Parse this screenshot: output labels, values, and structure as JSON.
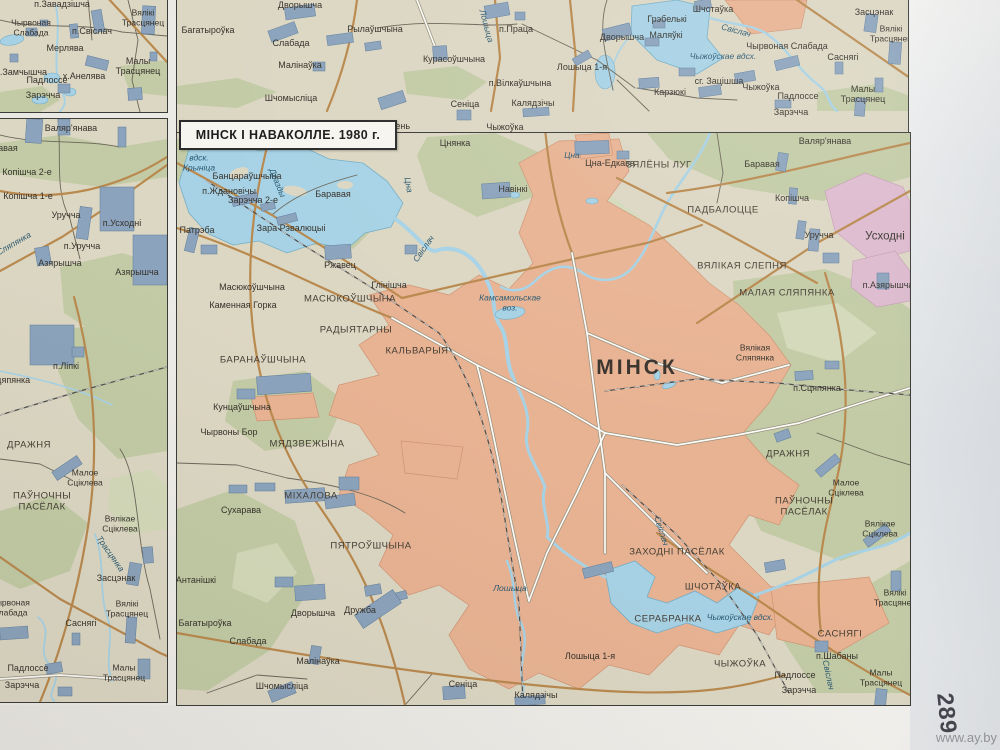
{
  "title": "МІНСК І НАВАКОЛЛЕ. 1980 г.",
  "page": {
    "number": "289",
    "watermark": "www.ay.by"
  },
  "colors": {
    "land": "#dcd7c3",
    "forest": "#c2cba5",
    "forest_light": "#d3d9b9",
    "urban": "#e8b393",
    "urban_edge": "#cf9474",
    "pink": "#ddbace",
    "water": "#a7d2e5",
    "water_edge": "#74aec7",
    "road_major": "#b9894e",
    "road_minor": "#fdfcf8",
    "road_casing": "#98927f",
    "road_small": "#6b6659",
    "rail": "#4e4c48",
    "building": "#8ba3bc",
    "building_edge": "#5f7d9c",
    "border": "#3b3b39",
    "label": "#36322b",
    "label_water": "#2c5a72",
    "title_bg": "#f7f5ef"
  },
  "panels": {
    "top_left": {
      "labels": [
        {
          "t": "п.Завадзішча",
          "x": 62,
          "y": 4,
          "c": "s"
        },
        {
          "t": "Чырвоная\nСлабада",
          "x": 31,
          "y": 28,
          "c": "s2"
        },
        {
          "t": "Вялікі\nТрасцянец",
          "x": 143,
          "y": 18,
          "c": "s2"
        },
        {
          "t": "п.Свіслач",
          "x": 92,
          "y": 31,
          "c": "s"
        },
        {
          "t": "Мерлява",
          "x": 65,
          "y": 48,
          "c": "s"
        },
        {
          "t": "Малы Трасцянец",
          "x": 138,
          "y": 66,
          "c": "s"
        },
        {
          "t": "п.Замчышча",
          "x": 21,
          "y": 72,
          "c": "s"
        },
        {
          "t": "х.Анелява",
          "x": 84,
          "y": 76,
          "c": "s"
        },
        {
          "t": "Падлоссе",
          "x": 47,
          "y": 80,
          "c": "s"
        },
        {
          "t": "Зарэчча",
          "x": 43,
          "y": 95,
          "c": "s"
        }
      ]
    },
    "top_right": {
      "labels": [
        {
          "t": "Багатыроўка",
          "x": 31,
          "y": 30,
          "c": "s"
        },
        {
          "t": "Дворышча",
          "x": 123,
          "y": 5,
          "c": "s"
        },
        {
          "t": "Рылаўшчына",
          "x": 198,
          "y": 29,
          "c": "s"
        },
        {
          "t": "Слабада",
          "x": 114,
          "y": 43,
          "c": "s"
        },
        {
          "t": "Малінаўка",
          "x": 123,
          "y": 65,
          "c": "s"
        },
        {
          "t": "Шчомысліца",
          "x": 114,
          "y": 98,
          "c": "s"
        },
        {
          "t": "Курасоўшчына",
          "x": 277,
          "y": 59,
          "c": "s"
        },
        {
          "t": "Лошыца",
          "x": 309,
          "y": 26,
          "c": "w2",
          "r": 75
        },
        {
          "t": "п.Праца",
          "x": 339,
          "y": 29,
          "c": "s"
        },
        {
          "t": "п.Вілкаўшчына",
          "x": 343,
          "y": 83,
          "c": "s"
        },
        {
          "t": "Сеніца",
          "x": 288,
          "y": 104,
          "c": "s"
        },
        {
          "t": "Калядзічы",
          "x": 356,
          "y": 103,
          "c": "s"
        },
        {
          "t": "Лошыца 1-я",
          "x": 405,
          "y": 67,
          "c": "s"
        },
        {
          "t": "Дворышча",
          "x": 445,
          "y": 37,
          "c": "s"
        },
        {
          "t": "Грэбелькі",
          "x": 490,
          "y": 19,
          "c": "s"
        },
        {
          "t": "Шчотаўка",
          "x": 536,
          "y": 9,
          "c": "s"
        },
        {
          "t": "Маляўкі",
          "x": 489,
          "y": 35,
          "c": "s"
        },
        {
          "t": "Свіслач",
          "x": 559,
          "y": 31,
          "c": "w2",
          "r": 15
        },
        {
          "t": "Чырвоная Слабада",
          "x": 610,
          "y": 46,
          "c": "s"
        },
        {
          "t": "Чыжоўскае вдсх.",
          "x": 546,
          "y": 57,
          "c": "w2"
        },
        {
          "t": "сг. Зацішша",
          "x": 542,
          "y": 81,
          "c": "s"
        },
        {
          "t": "Чыжоўка",
          "x": 584,
          "y": 87,
          "c": "s"
        },
        {
          "t": "Карзюкі",
          "x": 493,
          "y": 92,
          "c": "s"
        },
        {
          "t": "Падлоссе",
          "x": 621,
          "y": 96,
          "c": "s"
        },
        {
          "t": "Зарэчча",
          "x": 614,
          "y": 112,
          "c": "s"
        },
        {
          "t": "Саснягі",
          "x": 666,
          "y": 57,
          "c": "s"
        },
        {
          "t": "Малы Трасцянец",
          "x": 686,
          "y": 94,
          "c": "s"
        },
        {
          "t": "Засцэнак",
          "x": 697,
          "y": 12,
          "c": "s"
        },
        {
          "t": "Вялікі\nТрасцянец",
          "x": 714,
          "y": 34,
          "c": "s2"
        },
        {
          "t": "Зацень",
          "x": 218,
          "y": 126,
          "c": "s"
        },
        {
          "t": "Чыжоўка",
          "x": 328,
          "y": 127,
          "c": "s"
        }
      ]
    },
    "left": {
      "labels": [
        {
          "t": "Валяр'янава",
          "x": 71,
          "y": 9,
          "c": "s"
        },
        {
          "t": "Баравая",
          "x": 0,
          "y": 29,
          "c": "s"
        },
        {
          "t": "Копішча 2-е",
          "x": 27,
          "y": 53,
          "c": "s"
        },
        {
          "t": "Копішча 1-е",
          "x": 28,
          "y": 77,
          "c": "s"
        },
        {
          "t": "Уручча",
          "x": 66,
          "y": 96,
          "c": "s"
        },
        {
          "t": "п.Усходні",
          "x": 122,
          "y": 104,
          "c": "s"
        },
        {
          "t": "п.Уручча",
          "x": 82,
          "y": 127,
          "c": "s"
        },
        {
          "t": "Азярышча",
          "x": 60,
          "y": 144,
          "c": "s"
        },
        {
          "t": "Азярышча",
          "x": 137,
          "y": 153,
          "c": "s"
        },
        {
          "t": "Сляпянка",
          "x": 14,
          "y": 125,
          "c": "w2",
          "r": -30
        },
        {
          "t": "п.Ліпкі",
          "x": 66,
          "y": 247,
          "c": "s"
        },
        {
          "t": "Сцяпянка",
          "x": 10,
          "y": 261,
          "c": "s"
        },
        {
          "t": "ДРАЖНЯ",
          "x": 29,
          "y": 327,
          "c": "cap"
        },
        {
          "t": "Малое\nСціклева",
          "x": 85,
          "y": 359,
          "c": "s2"
        },
        {
          "t": "ПАЎНОЧНЫ\nПАСЁЛАК",
          "x": 42,
          "y": 383,
          "c": "cap2"
        },
        {
          "t": "Вялікае\nСціклева",
          "x": 120,
          "y": 405,
          "c": "s2"
        },
        {
          "t": "Трасцянка",
          "x": 110,
          "y": 435,
          "c": "w2",
          "r": 55
        },
        {
          "t": "Засцэнак",
          "x": 116,
          "y": 459,
          "c": "s"
        },
        {
          "t": "Вялікі\nТрасцянец",
          "x": 127,
          "y": 490,
          "c": "s2"
        },
        {
          "t": "Саснягі",
          "x": 81,
          "y": 504,
          "c": "s"
        },
        {
          "t": "Чырвоная\nСлабада",
          "x": 10,
          "y": 489,
          "c": "s2"
        },
        {
          "t": "Падлоссе",
          "x": 28,
          "y": 549,
          "c": "s"
        },
        {
          "t": "Зарэчча",
          "x": 22,
          "y": 566,
          "c": "s"
        },
        {
          "t": "Малы\nТрасцянец",
          "x": 124,
          "y": 554,
          "c": "s2"
        }
      ]
    },
    "main": {
      "labels": [
        {
          "t": "Цнянка",
          "x": 278,
          "y": 10,
          "c": "s"
        },
        {
          "t": "вдск.\nКрыніца",
          "x": 22,
          "y": 30,
          "c": "w2"
        },
        {
          "t": "Банцараўшчына",
          "x": 70,
          "y": 43,
          "c": "s"
        },
        {
          "t": "п.Ждановічы",
          "x": 52,
          "y": 58,
          "c": "s"
        },
        {
          "t": "Зарэчча 2-е",
          "x": 76,
          "y": 67,
          "c": "s"
        },
        {
          "t": "Баравая",
          "x": 156,
          "y": 61,
          "c": "s"
        },
        {
          "t": "Дразды",
          "x": 100,
          "y": 50,
          "c": "w2",
          "r": 68
        },
        {
          "t": "Цна",
          "x": 231,
          "y": 52,
          "c": "w2",
          "r": 80
        },
        {
          "t": "Патрэба",
          "x": 20,
          "y": 97,
          "c": "s"
        },
        {
          "t": "Зара Рэвалюцыі",
          "x": 114,
          "y": 95,
          "c": "s"
        },
        {
          "t": "Ржавец",
          "x": 163,
          "y": 132,
          "c": "s"
        },
        {
          "t": "Глінішча",
          "x": 212,
          "y": 152,
          "c": "s"
        },
        {
          "t": "Свіслач",
          "x": 247,
          "y": 116,
          "c": "w2",
          "r": -55
        },
        {
          "t": "Масюкоўшчына",
          "x": 75,
          "y": 154,
          "c": "s"
        },
        {
          "t": "Каменная Горка",
          "x": 66,
          "y": 172,
          "c": "s"
        },
        {
          "t": "МАСЮКОЎШЧЫНА",
          "x": 173,
          "y": 167,
          "c": "cap"
        },
        {
          "t": "Навінкі",
          "x": 336,
          "y": 56,
          "c": "s"
        },
        {
          "t": "Цна",
          "x": 395,
          "y": 23,
          "c": "w2"
        },
        {
          "t": "Цна-Едкава",
          "x": 433,
          "y": 30,
          "c": "s"
        },
        {
          "t": "ЗЯЛЁНЫ ЛУГ",
          "x": 482,
          "y": 33,
          "c": "cap"
        },
        {
          "t": "Валяр'янава",
          "x": 648,
          "y": 8,
          "c": "s"
        },
        {
          "t": "Баравая",
          "x": 585,
          "y": 31,
          "c": "s"
        },
        {
          "t": "Копішча",
          "x": 615,
          "y": 65,
          "c": "s"
        },
        {
          "t": "ПАДБАЛОЦЦЕ",
          "x": 546,
          "y": 78,
          "c": "cap"
        },
        {
          "t": "Уручча",
          "x": 642,
          "y": 102,
          "c": "s"
        },
        {
          "t": "Усходні",
          "x": 708,
          "y": 104,
          "c": "town"
        },
        {
          "t": "ВЯЛІКАЯ СЛЕПНЯ",
          "x": 565,
          "y": 134,
          "c": "cap"
        },
        {
          "t": "МАЛАЯ СЛЯПЯНКА",
          "x": 610,
          "y": 161,
          "c": "cap"
        },
        {
          "t": "п.Азярышча",
          "x": 711,
          "y": 152,
          "c": "s"
        },
        {
          "t": "Вялікая\nСляпянка",
          "x": 578,
          "y": 220,
          "c": "s2"
        },
        {
          "t": "МІНСК",
          "x": 460,
          "y": 235,
          "c": "city"
        },
        {
          "t": "Камсамольскае\nвоз.",
          "x": 333,
          "y": 170,
          "c": "w2"
        },
        {
          "t": "РАДЫЯТАРНЫ",
          "x": 179,
          "y": 198,
          "c": "cap"
        },
        {
          "t": "КАЛЬВАРЫЯ",
          "x": 240,
          "y": 219,
          "c": "cap"
        },
        {
          "t": "БАРАНАЎШЧЫНА",
          "x": 86,
          "y": 228,
          "c": "cap"
        },
        {
          "t": "Кунцаўшчына",
          "x": 65,
          "y": 274,
          "c": "s"
        },
        {
          "t": "Чырвоны Бор",
          "x": 52,
          "y": 299,
          "c": "s"
        },
        {
          "t": "МЯДЗВЕЖЫНА",
          "x": 130,
          "y": 312,
          "c": "cap"
        },
        {
          "t": "МІХАЛОВА",
          "x": 134,
          "y": 364,
          "c": "cap"
        },
        {
          "t": "Сухарава",
          "x": 64,
          "y": 377,
          "c": "s"
        },
        {
          "t": "ПЯТРОЎШЧЫНА",
          "x": 194,
          "y": 414,
          "c": "cap"
        },
        {
          "t": "Антанішкі",
          "x": 19,
          "y": 447,
          "c": "s"
        },
        {
          "t": "Дворышча",
          "x": 136,
          "y": 480,
          "c": "s"
        },
        {
          "t": "Дружба",
          "x": 183,
          "y": 477,
          "c": "s"
        },
        {
          "t": "Багатыроўка",
          "x": 28,
          "y": 490,
          "c": "s"
        },
        {
          "t": "Слабада",
          "x": 71,
          "y": 508,
          "c": "s"
        },
        {
          "t": "Малінаўка",
          "x": 141,
          "y": 528,
          "c": "s"
        },
        {
          "t": "Шчомысліца",
          "x": 105,
          "y": 553,
          "c": "s"
        },
        {
          "t": "Сеніца",
          "x": 286,
          "y": 551,
          "c": "s"
        },
        {
          "t": "Калядзічы",
          "x": 359,
          "y": 562,
          "c": "s"
        },
        {
          "t": "Лошыца",
          "x": 333,
          "y": 456,
          "c": "w2"
        },
        {
          "t": "Лошыца 1-я",
          "x": 413,
          "y": 523,
          "c": "s"
        },
        {
          "t": "ЗАХОДНІ ПАСЁЛАК",
          "x": 500,
          "y": 420,
          "c": "cap"
        },
        {
          "t": "Свіслач",
          "x": 484,
          "y": 398,
          "c": "w2",
          "r": 72
        },
        {
          "t": "ШЧОТАЎКА",
          "x": 536,
          "y": 455,
          "c": "cap"
        },
        {
          "t": "СЕРАБРАНКА",
          "x": 491,
          "y": 487,
          "c": "cap"
        },
        {
          "t": "Чыжоўскае вдсх.",
          "x": 563,
          "y": 485,
          "c": "w2"
        },
        {
          "t": "ЧЫЖОЎКА",
          "x": 563,
          "y": 532,
          "c": "cap"
        },
        {
          "t": "САСНЯГІ",
          "x": 663,
          "y": 502,
          "c": "cap"
        },
        {
          "t": "п.Шабаны",
          "x": 660,
          "y": 523,
          "c": "s"
        },
        {
          "t": "Падлоссе",
          "x": 618,
          "y": 542,
          "c": "s"
        },
        {
          "t": "Зарэчча",
          "x": 622,
          "y": 557,
          "c": "s"
        },
        {
          "t": "Свіслач",
          "x": 651,
          "y": 542,
          "c": "w2",
          "r": 78
        },
        {
          "t": "Малы\nТрасцянец",
          "x": 704,
          "y": 545,
          "c": "s2"
        },
        {
          "t": "Вялікі\nТрасцянец",
          "x": 718,
          "y": 465,
          "c": "s2"
        },
        {
          "t": "ДРАЖНЯ",
          "x": 611,
          "y": 322,
          "c": "cap"
        },
        {
          "t": "Малое\nСціклева",
          "x": 669,
          "y": 355,
          "c": "s2"
        },
        {
          "t": "ПАЎНОЧНЫ\nПАСЁЛАК",
          "x": 627,
          "y": 374,
          "c": "cap2"
        },
        {
          "t": "Вялікае\nСціклева",
          "x": 703,
          "y": 396,
          "c": "s2"
        },
        {
          "t": "п.Сцяпянка",
          "x": 640,
          "y": 255,
          "c": "s"
        }
      ]
    }
  }
}
